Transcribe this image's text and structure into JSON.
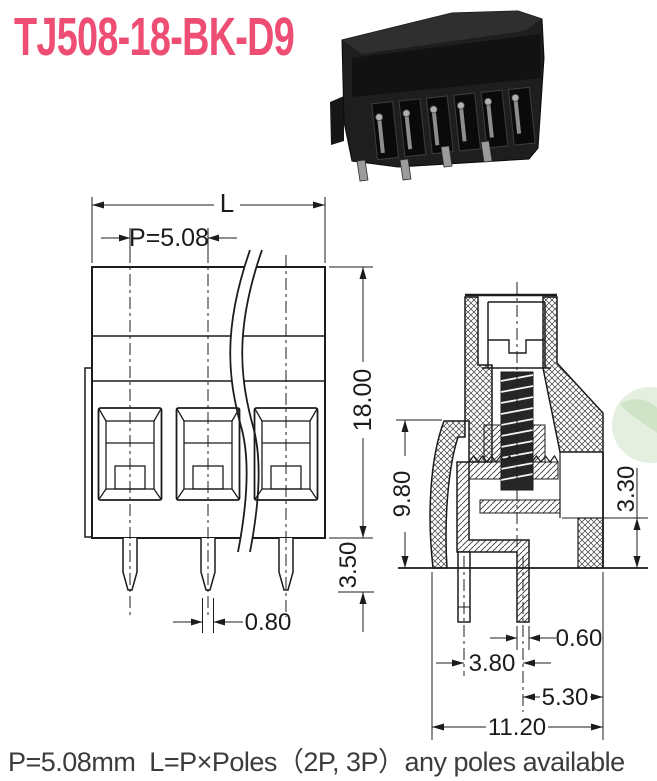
{
  "title": {
    "text": "TJ508-18-BK-D9"
  },
  "colors": {
    "title": "#ee4d74",
    "caption": "#3c3c3c",
    "line": "#1c1c1c",
    "watermark": "#e4efdf"
  },
  "photo": {
    "label": "terminal-block-photo",
    "poles_visible": 6
  },
  "views": {
    "front": {
      "dim_overall_width": "L",
      "dim_pitch": "P=5.08",
      "dim_height": "18.00",
      "dim_pin_length": "3.50",
      "dim_pin_width": "0.80"
    },
    "side": {
      "dim_body_height": "9.80",
      "dim_step_height": "3.30",
      "dim_pin_thickness": "0.60",
      "dim_pin_spacing": "3.80",
      "dim_pin_to_edge": "5.30",
      "dim_total_depth": "11.20"
    }
  },
  "caption": {
    "text": "P=5.08mm  L=P×Poles（2P, 3P）any poles available"
  }
}
